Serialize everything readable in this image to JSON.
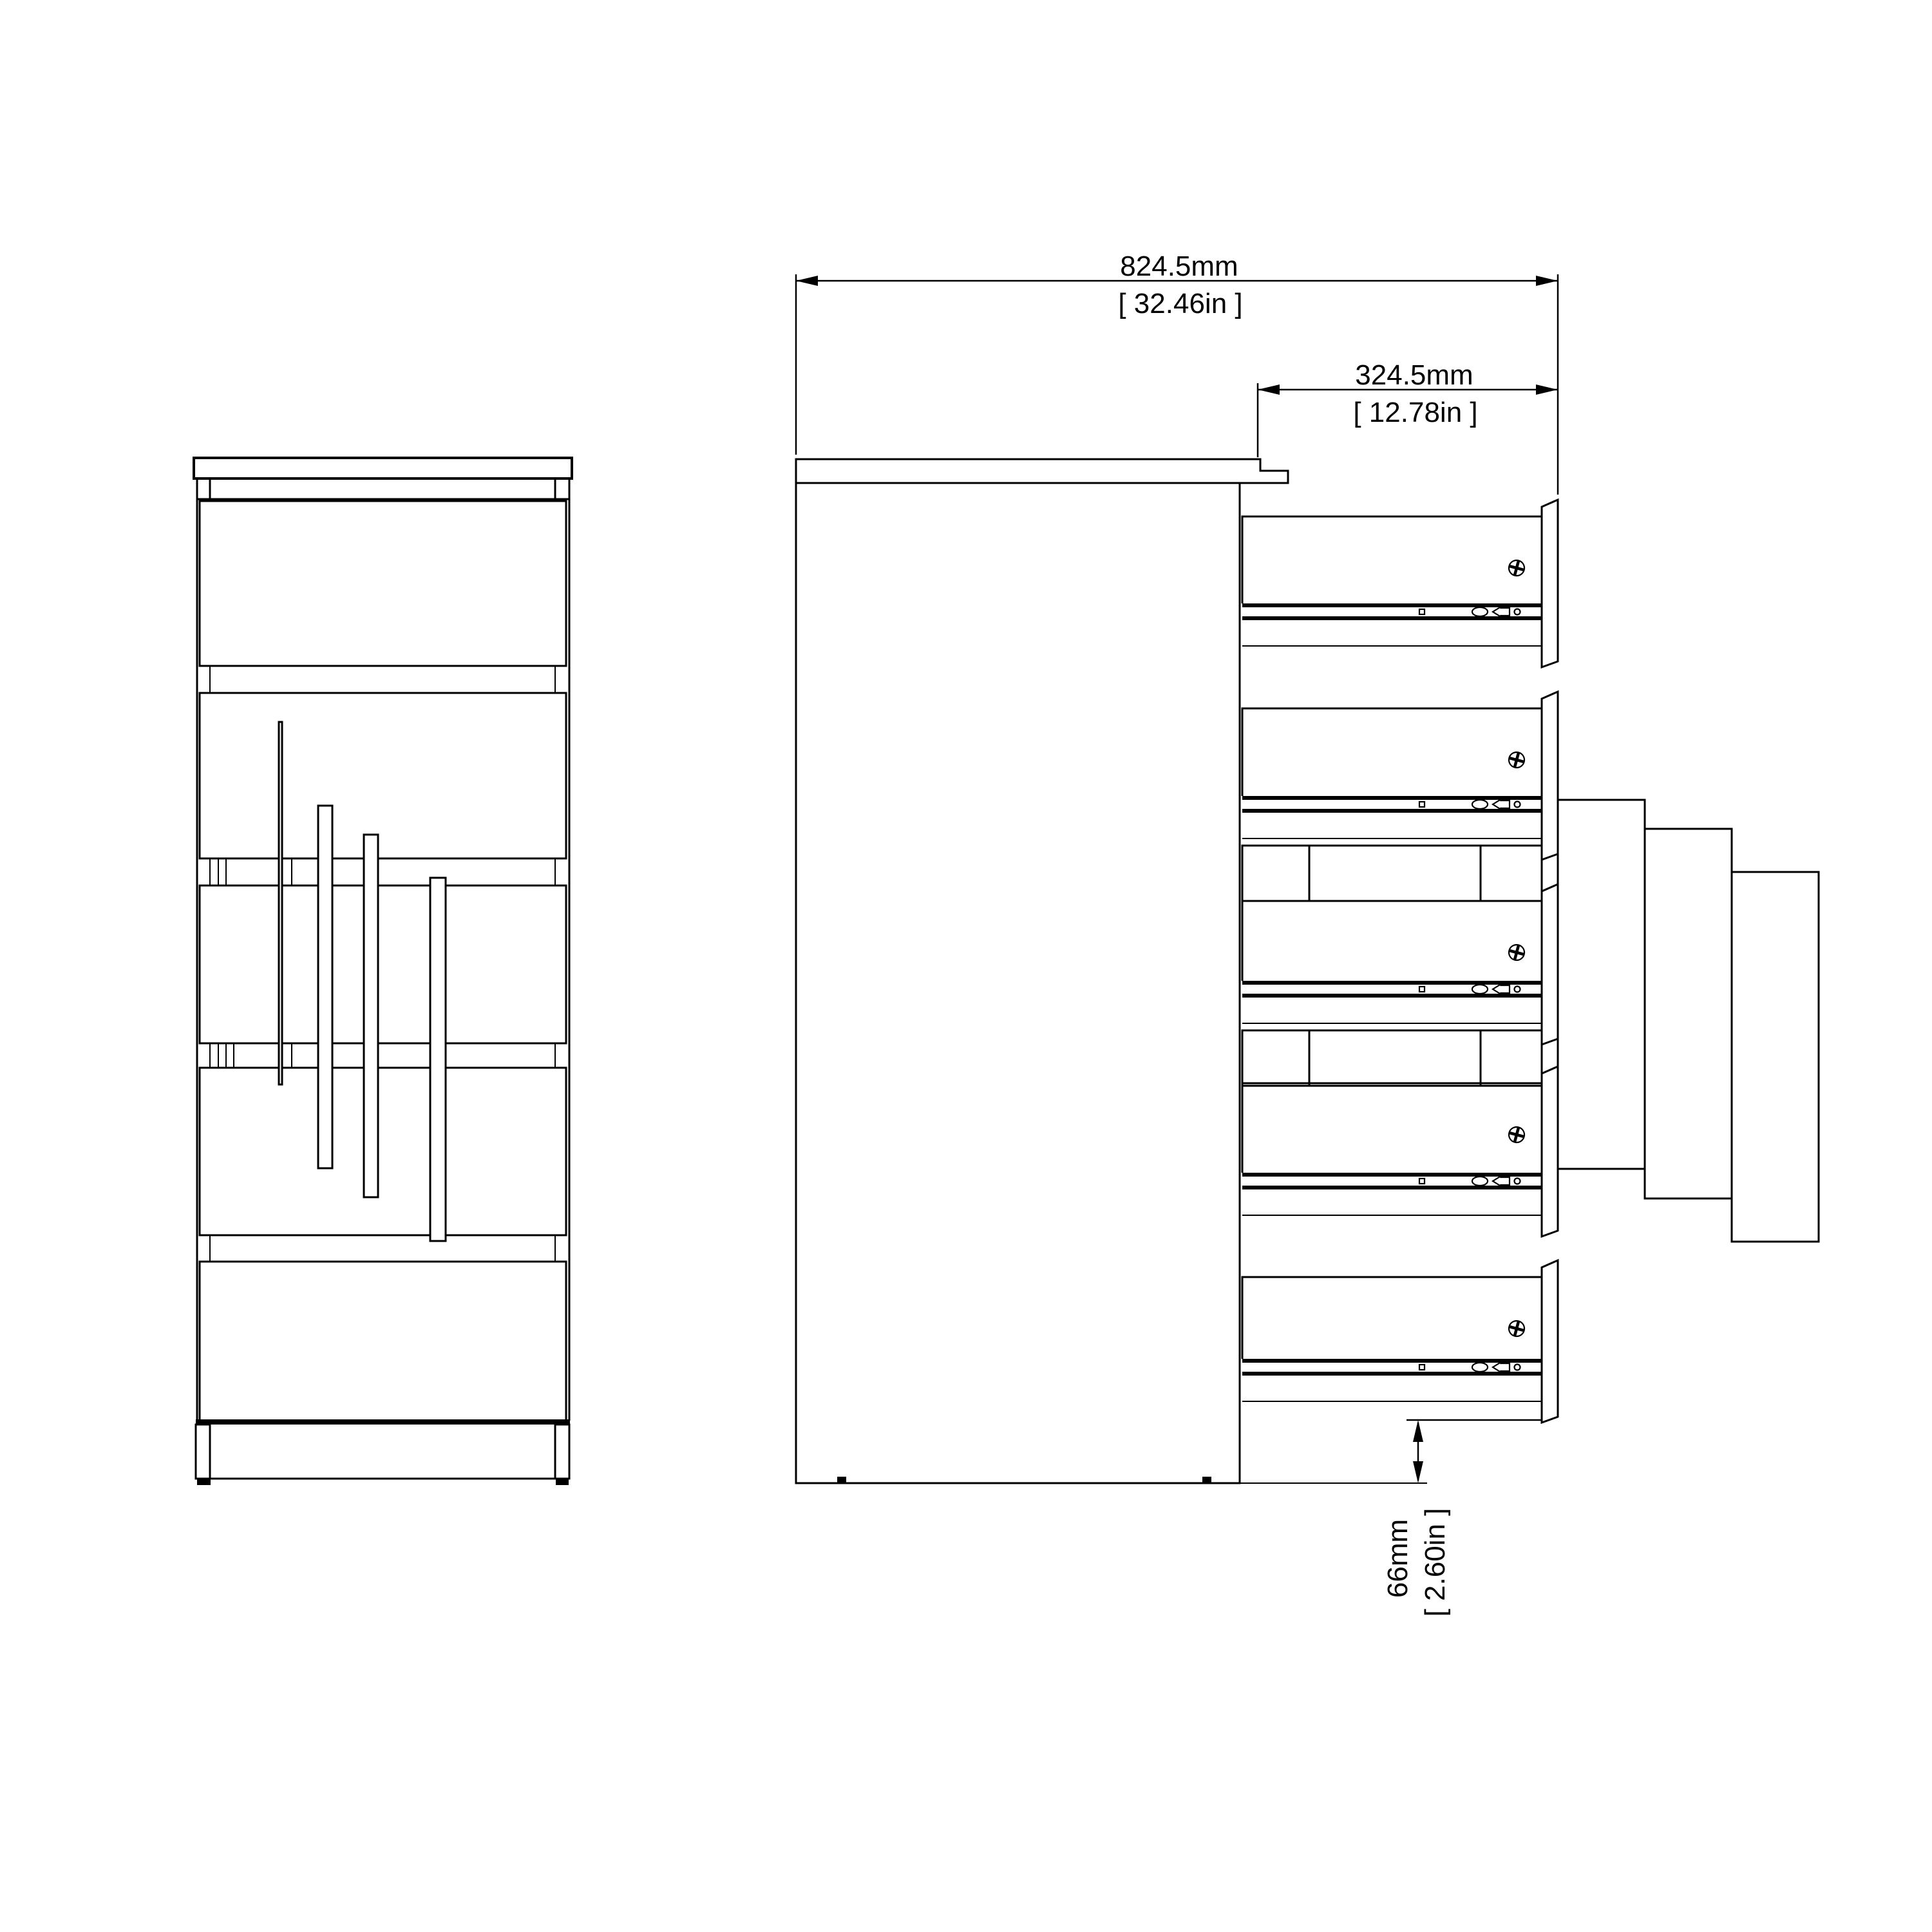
{
  "drawing": {
    "type": "furniture-technical-drawing",
    "product": "5-drawer narrow chest, front elevation and side elevation with drawers extended",
    "background_color": "#ffffff",
    "line_color": "#000000",
    "views": {
      "front": {
        "name": "front-elevation",
        "drawer_count": 5,
        "handle_count": 4
      },
      "side": {
        "name": "side-elevation-drawers-extended",
        "drawer_count": 5
      }
    },
    "dimensions": {
      "total_depth_open": {
        "metric": "824.5mm",
        "imperial": "[ 32.46in ]"
      },
      "drawer_extension": {
        "metric": "324.5mm",
        "imperial": "[ 12.78in ]"
      },
      "floor_clearance": {
        "metric": "66mm",
        "imperial": "[ 2.60in ]"
      }
    },
    "icons": {
      "cam-lock-icon": "circle with phillips cross (cam fitting)",
      "slide-stop-icon": "small square on slide rail",
      "slide-roller-icon": "oval roller on slide rail",
      "slide-latch-icon": "arrow latch on slide rail",
      "slide-screw-icon": "small round screw on slide rail",
      "foot-glide-icon": "black floor glide pad",
      "dimension-arrow-icon": "filled triangular dimension arrowhead"
    }
  }
}
